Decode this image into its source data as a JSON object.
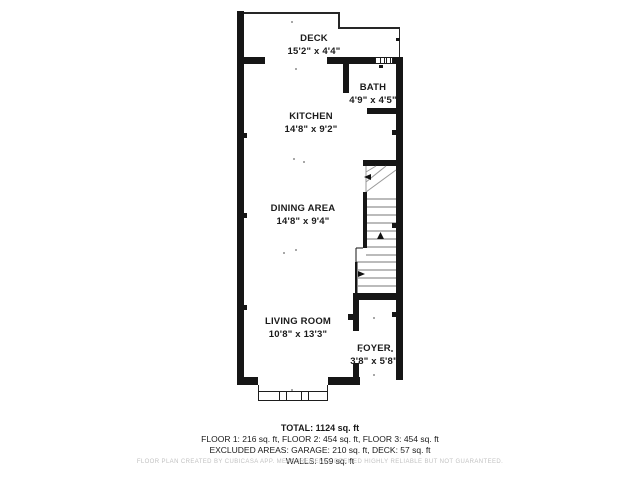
{
  "floorplan": {
    "rooms": [
      {
        "name": "DECK",
        "dimensions": "15'2\" x 4'4\""
      },
      {
        "name": "BATH",
        "dimensions": "4'9\" x 4'5\""
      },
      {
        "name": "KITCHEN",
        "dimensions": "14'8\" x 9'2\""
      },
      {
        "name": "DINING AREA",
        "dimensions": "14'8\" x 9'4\""
      },
      {
        "name": "LIVING ROOM",
        "dimensions": "10'8\" x 13'3\""
      },
      {
        "name": "FOYER",
        "dimensions": "3'8\" x 5'8\""
      }
    ]
  },
  "summary": {
    "total": "TOTAL: 1124 sq. ft",
    "floors": "FLOOR 1: 216 sq. ft, FLOOR 2: 454 sq. ft, FLOOR 3: 454 sq. ft",
    "excluded": "EXCLUDED AREAS: GARAGE: 210 sq. ft, DECK: 57 sq. ft",
    "walls": "WALLS: 159 sq. ft"
  },
  "disclaimer": "FLOOR PLAN CREATED BY CUBICASA APP. MEASUREMENTS DEEMED HIGHLY RELIABLE BUT NOT GUARANTEED.",
  "colors": {
    "wall": "#161616",
    "background": "#ffffff",
    "tread_line": "#777777",
    "disclaimer_text": "#c2c2c2"
  }
}
